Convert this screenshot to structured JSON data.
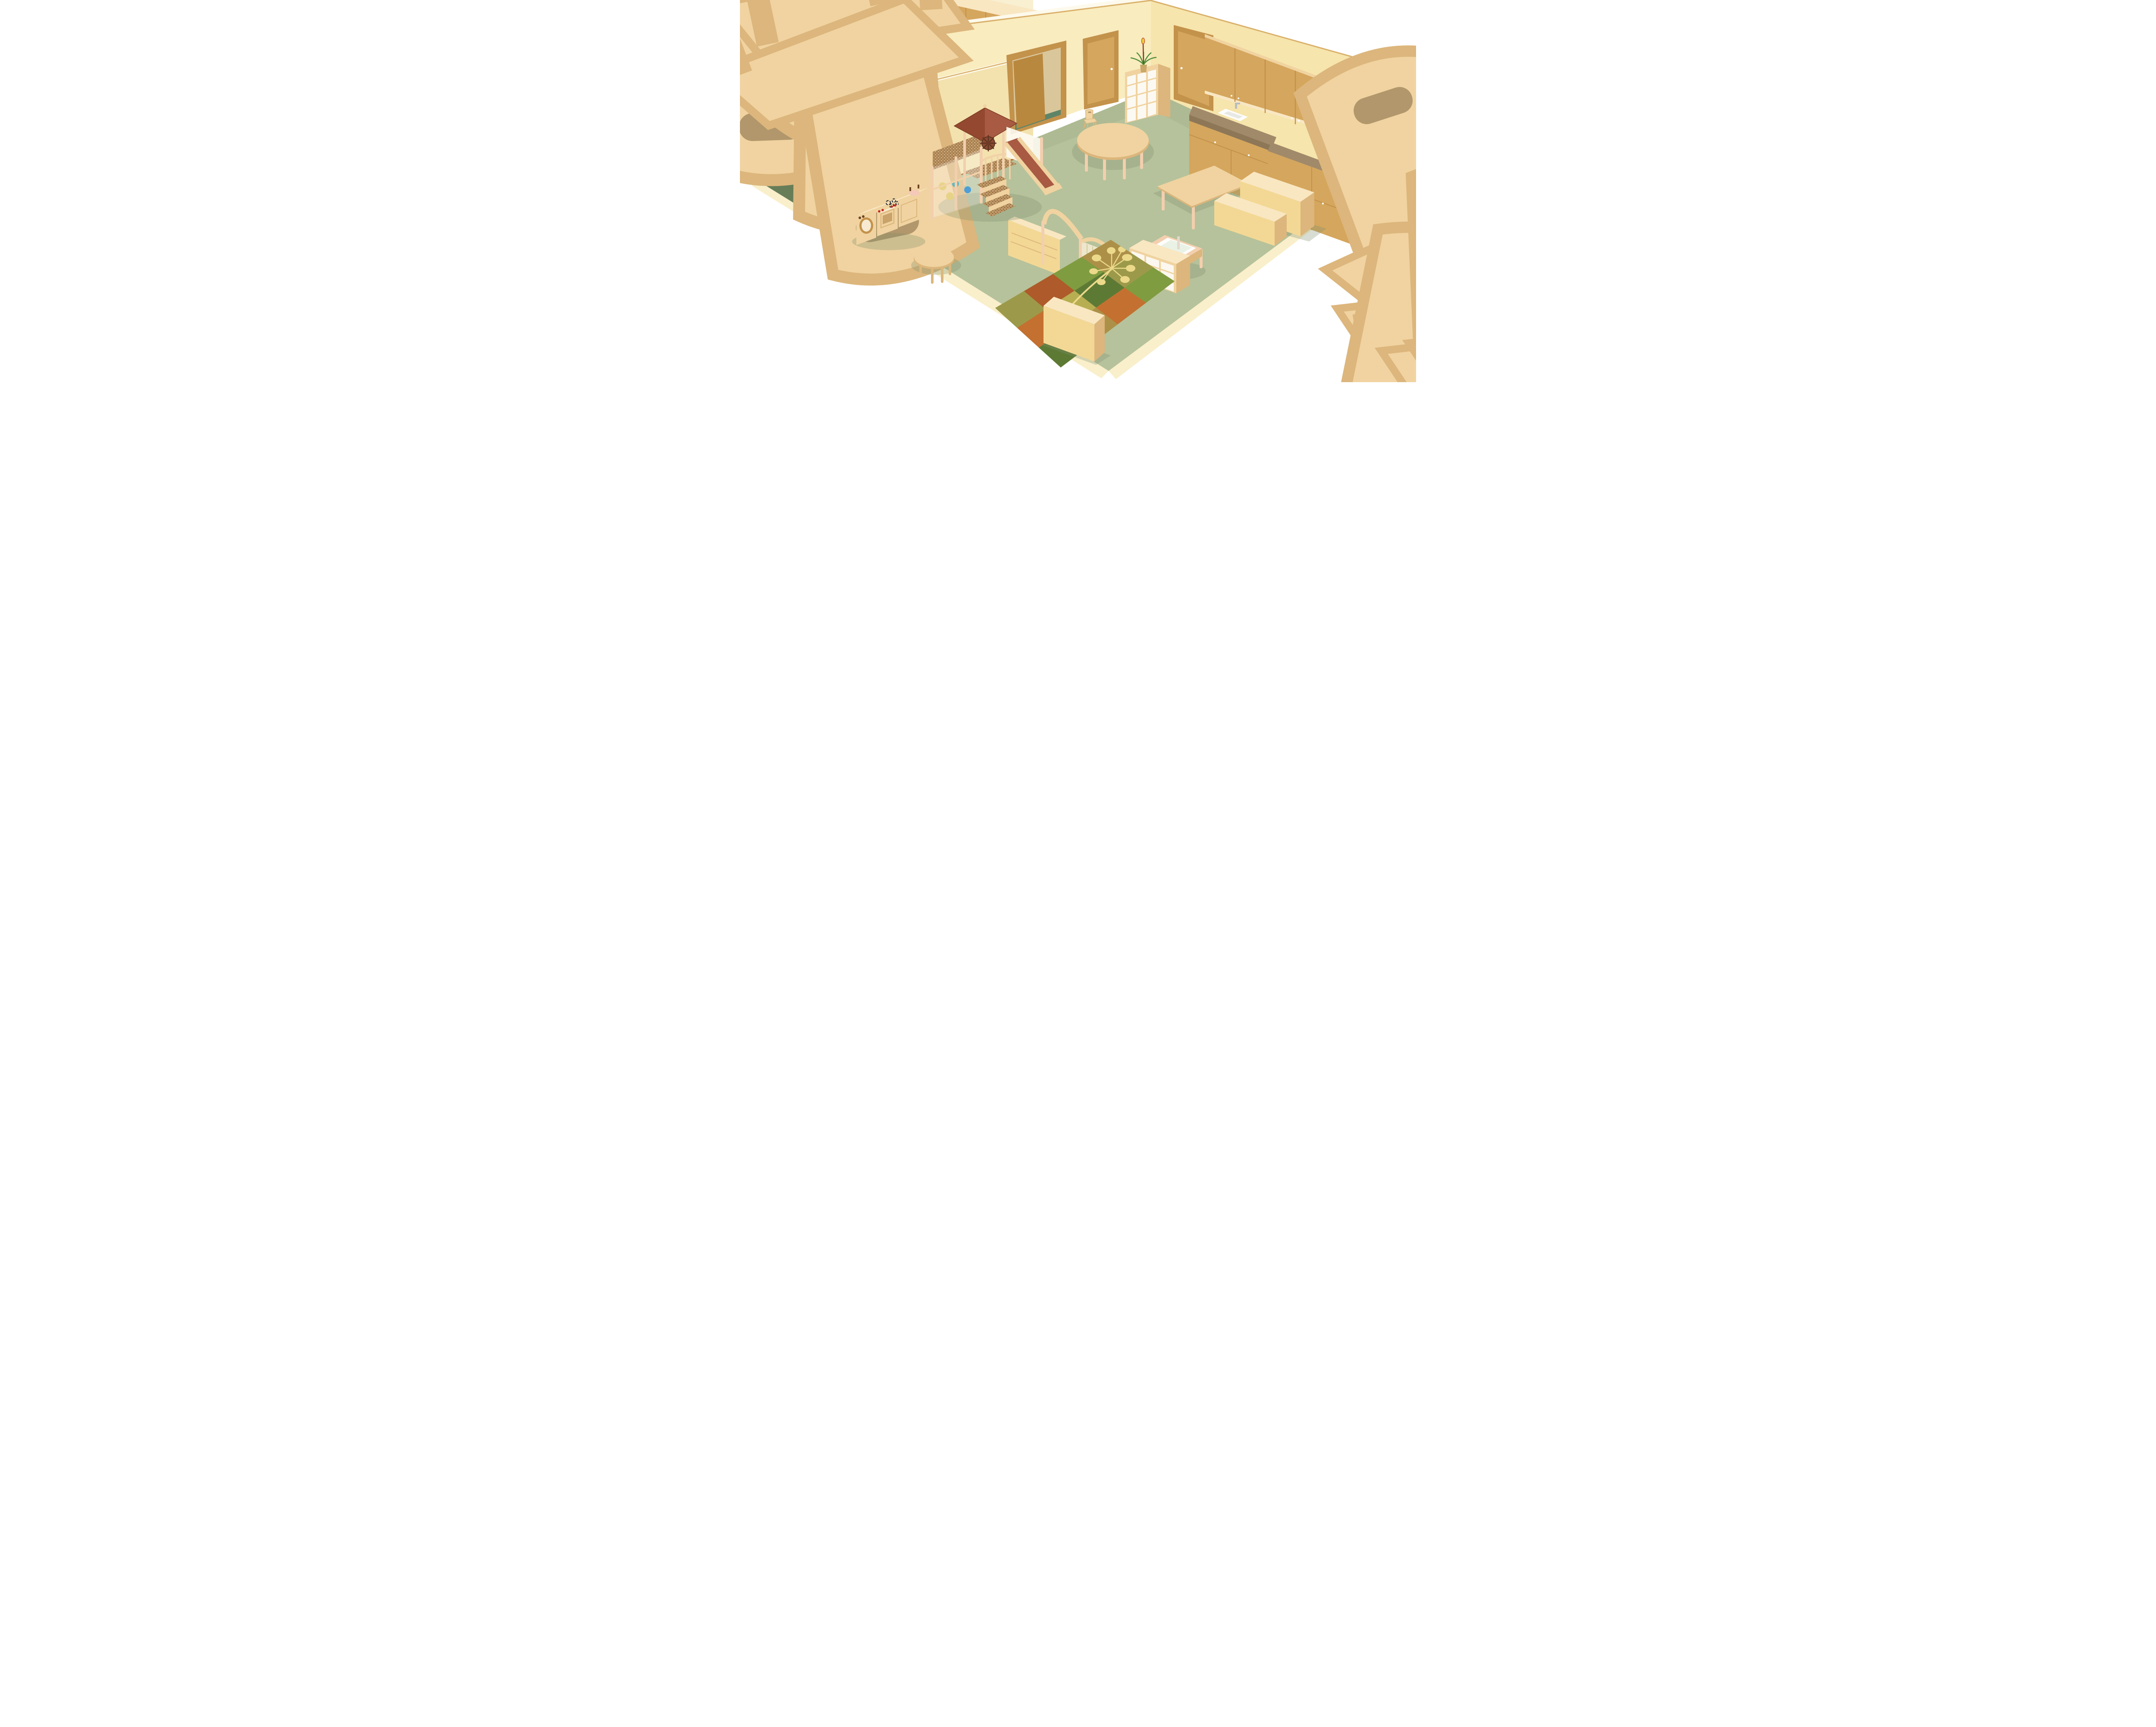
{
  "meta": {
    "title": "Preschool classroom - 3D isometric floor plan render",
    "render_style": "cutaway isometric 3D",
    "background": "white"
  },
  "palette": {
    "bg": "#ffffff",
    "floor": "#b6c29b",
    "floorShade": "#a3b289",
    "cutBand": "#f9efca",
    "cutEdge": "#fdf9ec",
    "wallA": "#f9ecbf",
    "wallB": "#f6e5ac",
    "wallC": "#f9f0d2",
    "wallDeep": "#f3e2ae",
    "woodTrim": "#d9b06a",
    "baseboard": "#a96f33",
    "oak": "#d5a65d",
    "oakFrame": "#c3924b",
    "oakDark": "#b9883f",
    "lightWood": "#f0d3a0",
    "lightWoodSide": "#dcb67c",
    "plywood": "#f3d895",
    "paleTop": "#f9e7c2",
    "granite": "#a18a6a",
    "graniteDark": "#8d7757",
    "red": "#a85a43",
    "redDark": "#93482f",
    "speckle": "#bb9362",
    "speckleDark": "#6f4a26",
    "carpet": "#667d58",
    "carpetDark": "#56684a",
    "white": "#fdfdfb",
    "pinkPlastic": "#f3cfae",
    "sinkPink": "#f5c9b8",
    "knobRed": "#c42b20",
    "knobBrown": "#6f4523",
    "ballYellow": "#e7d387",
    "ballTeal": "#5fb8c0",
    "ballBlue": "#4f9fd6",
    "rugOlive": "#9c9a4a",
    "rugGreenDark": "#5d7a35",
    "rugGreen": "#7f9c40",
    "rugOrange": "#c47030",
    "rugRust": "#ae5a2a",
    "rugTan": "#ac9048",
    "rugYellowGreen": "#b7ae52",
    "rugMotif": "#ecd98a",
    "leafGreen": "#4f8f3a",
    "potTan": "#c9a86a",
    "frameBrown": "#8a5a2a",
    "artBg": "#fbf4c8",
    "treeGreen": "#6cb83e",
    "treeTrunk": "#2e2a24",
    "shadow": "#7f8e6d"
  },
  "areas": [
    {
      "id": "main-floor",
      "label": "Main classroom floor (sage green vinyl)"
    },
    {
      "id": "left-room",
      "label": "Adjacent corridor room with dark green carpet"
    },
    {
      "id": "back-left-wall",
      "label": "Back-left wall with two interior doors"
    },
    {
      "id": "back-right-wall",
      "label": "Back-right wall with kitchenette"
    }
  ],
  "furniture": [
    {
      "id": 0,
      "label": "Framed safari animals artwork (tree, monkey, giraffe, elephant, tiger, zebra)"
    },
    {
      "id": 1,
      "label": "Tall built-in wardrobe closet"
    },
    {
      "id": 2,
      "label": "Interior oak door (left, ajar to carpeted room)"
    },
    {
      "id": 3,
      "label": "Interior oak door (middle)"
    },
    {
      "id": 4,
      "label": "Interior oak door (right wall)"
    },
    {
      "id": 5,
      "label": "12-bin storage cubby with potted bromeliad plant"
    },
    {
      "id": 6,
      "label": "Upper oak wall cabinets"
    },
    {
      "id": 7,
      "label": "Kitchenette counter with granite top and white sink"
    },
    {
      "id": 8,
      "label": "Oak base cabinets"
    },
    {
      "id": 9,
      "label": "Tall granite-top storage hutch"
    },
    {
      "id": 10,
      "label": "Round activity table with six toddler chairs"
    },
    {
      "id": 11,
      "label": "Rectangular activity table with six toddler chairs"
    },
    {
      "id": 12,
      "label": "Toddler chair beside storage cabinets"
    },
    {
      "id": 13,
      "label": "L-shaped pair of plywood storage cabinets"
    },
    {
      "id": 14,
      "label": "Sand and water sensory table"
    },
    {
      "id": 15,
      "label": "9-bin storage cubby"
    },
    {
      "id": 16,
      "label": "Arched room divider with sloped book display"
    },
    {
      "id": 17,
      "label": "Curved translucent reed divider panel"
    },
    {
      "id": 18,
      "label": "Slatted wood divider panel"
    },
    {
      "id": 19,
      "label": "Patchwork area rug with dandelion seed-head motif"
    },
    {
      "id": 20,
      "label": "Low plywood bookshelf on rug"
    },
    {
      "id": 21,
      "label": "Toy play kitchen: washer, stove with red knobs, pink sink"
    },
    {
      "id": 22,
      "label": "Small round toddler table with two chairs"
    },
    {
      "id": 23,
      "label": "Indoor play structure: red canopy tower, ship wheel, slide, ball pit, speckled stairs"
    }
  ],
  "artwork": {
    "subject": "safari animals under a tree",
    "animals": [
      "monkey",
      "giraffe",
      "elephant",
      "tiger",
      "zebra"
    ],
    "background": "#fbf4c8",
    "frame": "#8a5a2a"
  },
  "rug": {
    "motif": "dandelion seed head",
    "tile_colors": [
      "#9c9a4a",
      "#ae5a2a",
      "#7f9c40",
      "#ac9048",
      "#c47030",
      "#b7ae52",
      "#5d7a35"
    ]
  },
  "counts": {
    "doors": 3,
    "round_table_chairs": 6,
    "rect_table_chairs": 6,
    "toddler_table_chairs": 2,
    "cubby_bins_large": 12,
    "cubby_bins_small": 9,
    "play_kitchen_burners": 4
  }
}
